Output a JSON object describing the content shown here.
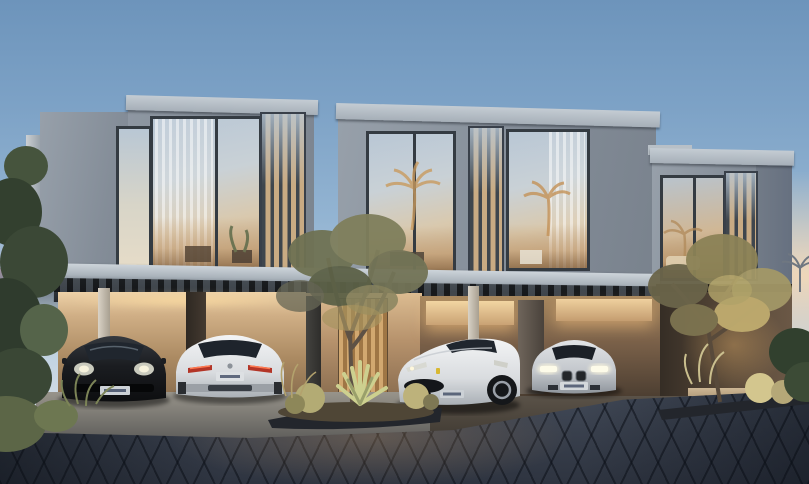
{
  "meta": {
    "description": "Dusk exterior rendering of a modern two-storey townhouse row with four luxury cars parked in covered carports, cobblestone paver driveway and desert-style landscaping"
  },
  "palette": {
    "sky_top": "#6d94bb",
    "sky_mid": "#93b4d2",
    "sky_light": "#d3dde6",
    "sunset_glow": "#f3d8b8",
    "dusk_pink": "#cdaab9",
    "hill": "#6e7a88",
    "concrete_roof": "#b2bac2",
    "concrete_face": "#8e97a1",
    "window_frame": "#343b42",
    "glass_cool": "#c2cfdb",
    "glass_warm": "#d8b888",
    "louver": "#3f464d",
    "soffit": "#24282e",
    "carport_wall_lit": "#eed2a8",
    "carport_wall_dark": "#514234",
    "door_wood": "#c89f6a",
    "warm_light": "#f0d2a0",
    "floor_concrete": "#98948b",
    "paver_dark": "#39404d",
    "paver_glow": "#c49662",
    "foliage_dark": "#33402f",
    "foliage_mid": "#55644a",
    "foliage_olive": "#7f7f5c",
    "foliage_lit": "#c0ac6f",
    "cactus": "#b3ab74",
    "agave": "#cdd08f",
    "trunk": "#5e5145",
    "planter_curb": "#23262c",
    "car_black": "#17191c",
    "car_glass": "#20262e",
    "car_white": "#eceeee",
    "car_white_shade": "#b9bec4",
    "car_silver": "#d3d6da",
    "tail_red": "#b33527",
    "headlight_lit": "#f6f2dc",
    "headlight_cool": "#d8d9d2",
    "plate": "#ccd1d6",
    "wheel": "#15171a",
    "rim": "#9aa0a8",
    "palm_reflection": "#c89a5e"
  },
  "scene": {
    "setting": "dusk",
    "building": {
      "type": "modern cubic townhouse row",
      "storeys": 2,
      "upper_volumes": 3,
      "features": [
        "floor-to-ceiling glass windows",
        "vertical louver screens",
        "sheer curtains",
        "warm interior lighting",
        "covered carports with slatted pergola soffits",
        "central timber entry door"
      ]
    },
    "cars": [
      {
        "name": "dark-sports-car",
        "body_color": "black",
        "view": "front",
        "parked": "left carport",
        "license_plate": "illegible"
      },
      {
        "name": "white-coupe",
        "body_color": "white",
        "view": "rear",
        "parked": "left carport",
        "license_plate": "illegible"
      },
      {
        "name": "white-grand-tourer",
        "body_color": "white",
        "view": "front three-quarter",
        "parked": "right carport",
        "license_plate": "illegible"
      },
      {
        "name": "silver-sedan",
        "body_color": "silver",
        "view": "front",
        "parked": "right carport",
        "license_plate": "illegible"
      }
    ],
    "landscaping": [
      "olive tree in central planter island",
      "agave and barrel cacti",
      "ornamental grasses",
      "uplit olive tree at right planter",
      "dense green trees at far left",
      "distant hills under pink dusk sky at left horizon",
      "golden palm reflections in upper windows",
      "clipped hedge at far right"
    ],
    "ground": "dark cobblestone paver driveway with warm light reflection"
  }
}
